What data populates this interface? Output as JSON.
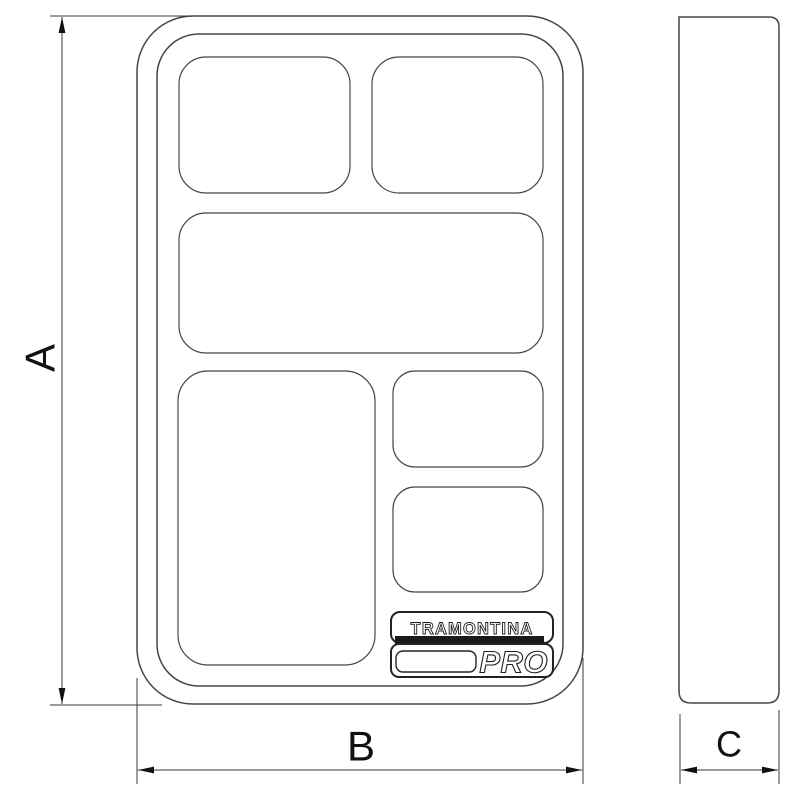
{
  "canvas": {
    "background": "#ffffff",
    "line_color": "#454545",
    "dimension_color": "#3a3a3a",
    "text_color": "#111111",
    "logo_bar_color": "#1a1a1a"
  },
  "dimensions": {
    "a_label": "A",
    "b_label": "B",
    "c_label": "C"
  },
  "logo": {
    "brand": "TRAMONTINA",
    "series": "PRO"
  }
}
